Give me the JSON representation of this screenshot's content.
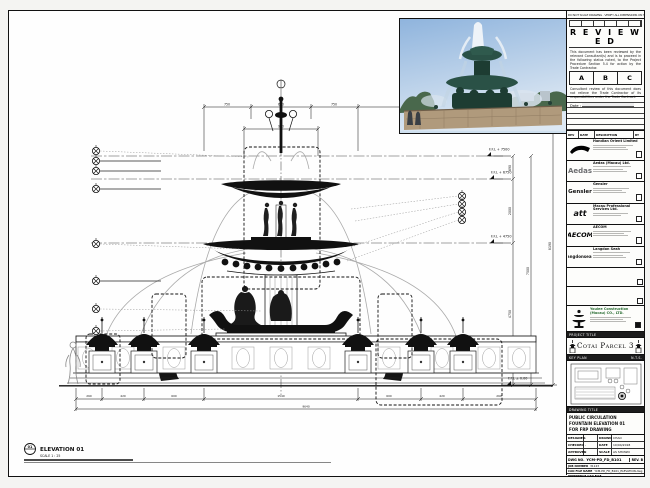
{
  "sheet": {
    "strip_note": "DO NOT SCALE DRAWING · VERIFY ALL DIMENSIONS ON SITE · REPORT DISCREPANCIES",
    "elevation_label": {
      "bubble": "01",
      "title": "ELEVATION 01",
      "scale": "SCALE 1 : 25"
    }
  },
  "stamp": {
    "title": "R E V I E W E D",
    "para1": "This document has been reviewed by the relevant Consultant(s) and is to proceed in the following status noted, to the Project Procedure Section 5.4 for action by the Trade Contractor.",
    "options": [
      "A",
      "B",
      "C"
    ],
    "para2": "Consultant review of this document does not relieve the Trade Contractor of its responsibilities under the Trade Contract.",
    "date_label": "Date :"
  },
  "revision_table": {
    "headers": [
      "REV",
      "DATE",
      "DESCRIPTION",
      "BY"
    ]
  },
  "consultants": [
    {
      "logo_text": "",
      "name": "Handian Orient Limited"
    },
    {
      "logo_text": "Aedas",
      "name": "Aedas (Macau) Ltd."
    },
    {
      "logo_text": "Gensler",
      "name": "Gensler"
    },
    {
      "logo_text": "att",
      "name": "Macau Professional Services Ltd."
    },
    {
      "logo_text": "AECOM",
      "name": "AECOM"
    },
    {
      "logo_text": "langdonseah",
      "name": "Langdon Seah"
    }
  ],
  "contractor": {
    "line1": "Youlee Construction",
    "line2": "(Macau) CO., LTD."
  },
  "project": {
    "label": "PROJECT TITLE",
    "title": "Cotai Parcel 3"
  },
  "key_plan": {
    "label": "KEY PLAN",
    "right": "N.T.S."
  },
  "drawing_title": {
    "label": "DRAWING TITLE",
    "line1": "PUBLIC CIRCULATION",
    "line2": "FOUNTAIN ELEVATION 01",
    "line3": "FOR FRP DRAWING"
  },
  "fields": {
    "designed_label": "DESIGNED",
    "designed": "-",
    "drawn_label": "DRAWN",
    "drawn": "CHAO",
    "checked_label": "CHECKED",
    "checked": "-",
    "date_label": "DATE",
    "date": "10/04/2018",
    "approved_label": "APPROVED",
    "approved": "-",
    "scale_label": "SCALE",
    "scale": "AS SHOWN"
  },
  "dwg": {
    "label": "DWG NO.",
    "number": "YCM-PD_FD_B101",
    "rev": "REV. B"
  },
  "admin": [
    {
      "label": "JOB NUMBER",
      "value": "31123"
    },
    {
      "label": "CAD FILE NAME",
      "value": "YCM-PD_FD_B101_ELEVATION.dwg"
    },
    {
      "label": "REFERENCE CAD FILE",
      "value": "-"
    }
  ],
  "levels": [
    "F.F.L + 7500",
    "F.F.L + 6750",
    "F.F.L + 4750",
    "F.F.L ± 0.00"
  ],
  "dims": {
    "top": [
      "750",
      "600",
      "750"
    ],
    "mid": "940",
    "right": [
      "690",
      "2000",
      "4750",
      "7500",
      "8190"
    ],
    "bottom": [
      "260",
      "420",
      "600",
      "1540",
      "600",
      "420",
      "260"
    ],
    "total": "9640"
  },
  "colors": {
    "line": "#1a1a1a",
    "sky": "#a8c4e0",
    "fountain_bronze": "#2a5146",
    "basin_stone": "#b09a7c"
  }
}
